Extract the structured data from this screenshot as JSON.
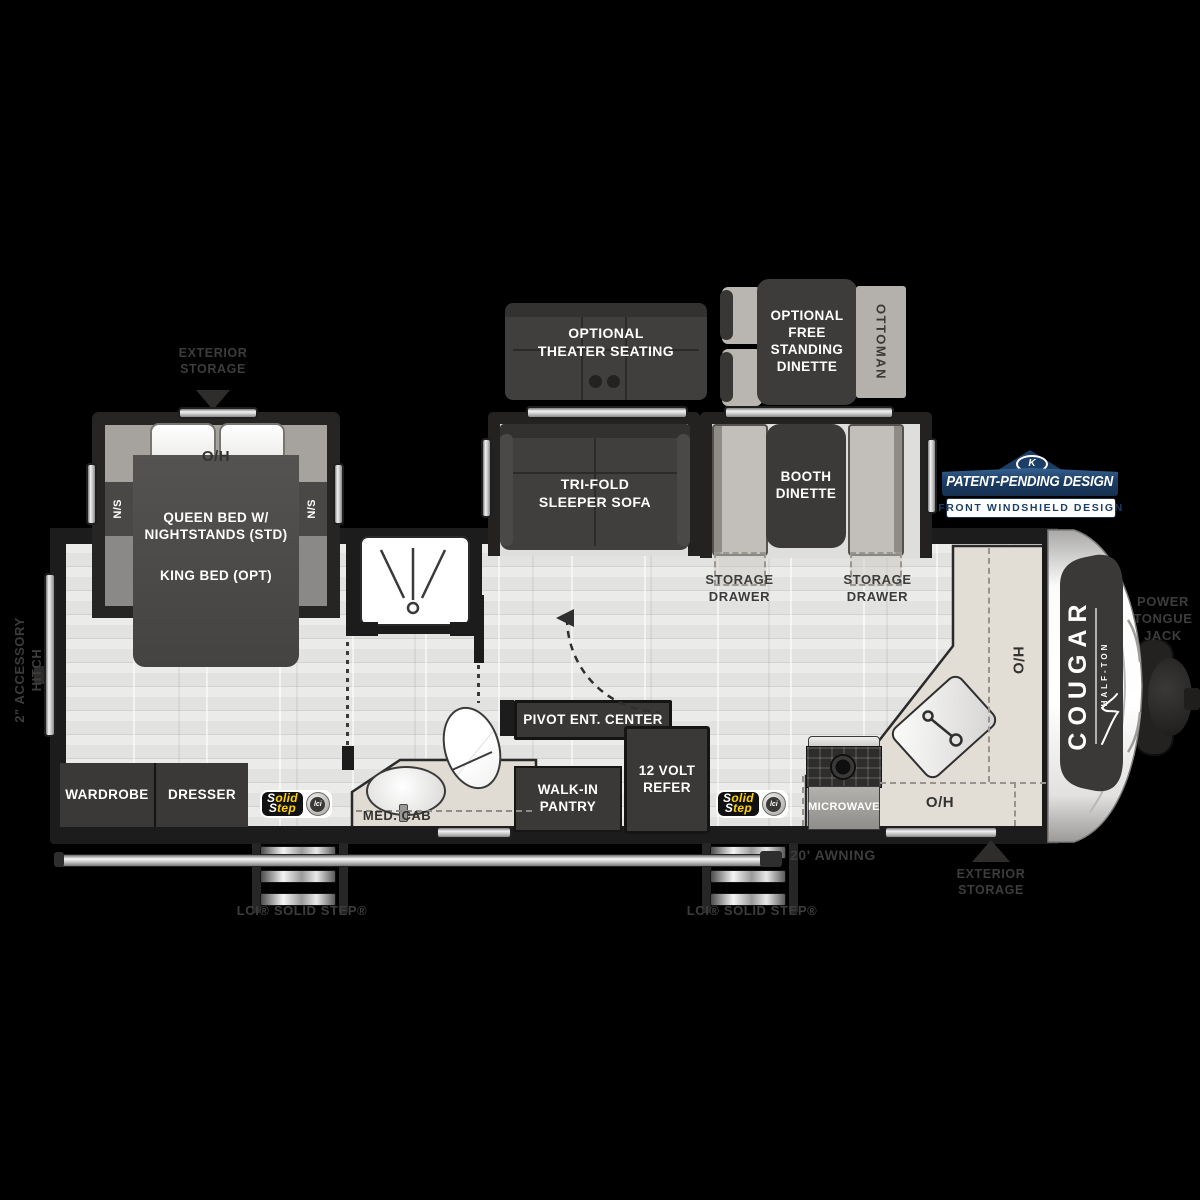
{
  "title": "Cougar Half-Ton travel trailer floor plan",
  "colors": {
    "background": "#000000",
    "wall": "#1c1c1c",
    "floor": "#e7e6e5",
    "furniture_dark": "#3b3937",
    "bench_gray": "#c2bfba",
    "counter_beige": "#e2ded6",
    "badge_navy": "#1d3e66",
    "solid_step_yellow": "#ffd200",
    "exterior_label_gray": "#3c3c3c",
    "white": "#ffffff"
  },
  "optional": {
    "theater": {
      "l1": "OPTIONAL",
      "l2": "THEATER SEATING"
    },
    "dinette": {
      "l1": "OPTIONAL",
      "l2": "FREE",
      "l3": "STANDING",
      "l4": "DINETTE"
    },
    "ottoman": "OTTOMAN"
  },
  "living": {
    "sofa": {
      "l1": "TRI-FOLD",
      "l2": "SLEEPER SOFA"
    },
    "booth": {
      "l1": "BOOTH",
      "l2": "DINETTE"
    },
    "storage_drawer": {
      "l1": "STORAGE",
      "l2": "DRAWER"
    },
    "ent_center": "PIVOT ENT. CENTER",
    "pantry": {
      "l1": "WALK-IN",
      "l2": "PANTRY"
    },
    "refer": {
      "l1": "12 VOLT",
      "l2": "REFER"
    },
    "microwave": "MICROWAVE",
    "overhead": "O/H"
  },
  "bedroom": {
    "overhead": "O/H",
    "nightstand": "N/S",
    "bed_std": "QUEEN BED W/ NIGHTSTANDS (STD)",
    "bed_opt": "KING BED (OPT)",
    "wardrobe": "WARDROBE",
    "dresser": "DRESSER"
  },
  "bath": {
    "med_cab": "MED. CAB"
  },
  "front": {
    "hutch": "H/O",
    "brand": "COUGAR",
    "sub_brand": "HALF-TON",
    "tongue_jack": {
      "l1": "POWER",
      "l2": "TONGUE",
      "l3": "JACK"
    }
  },
  "exterior": {
    "storage": {
      "l1": "EXTERIOR",
      "l2": "STORAGE"
    },
    "awning": "20' AWNING",
    "solid_step_label": "LCI® SOLID STEP®",
    "hitch": {
      "l1": "2\" ACCESSORY",
      "l2": "HITCH"
    },
    "solid_step_logo": {
      "l1": "Solid",
      "l2": "Step",
      "lci": "lci"
    }
  },
  "badge": {
    "k_mark": "K",
    "title": "PATENT-PENDING DESIGN",
    "subtitle": "FRONT WINDSHIELD DESIGN"
  }
}
